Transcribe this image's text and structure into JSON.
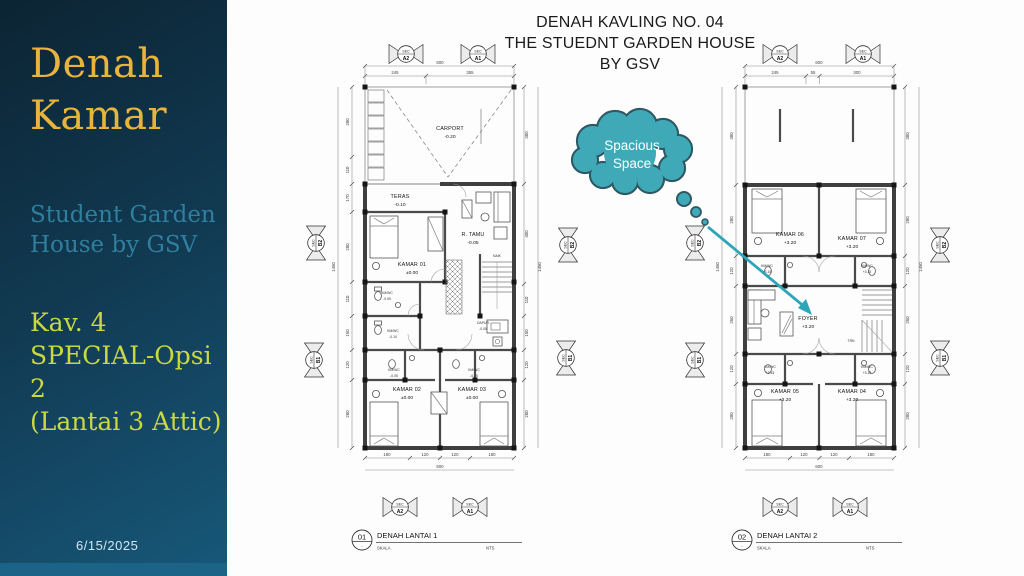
{
  "sidebar": {
    "title1": "Denah",
    "title2": "Kamar",
    "sub1": "Student Garden",
    "sub2": "House by GSV",
    "opt1": "Kav. 4",
    "opt2": "SPECIAL-Opsi 2",
    "opt3": "(Lantai 3 Attic)",
    "date": "6/15/2025"
  },
  "header": {
    "l1": "DENAH KAVLING NO. 04",
    "l2": "THE STUEDNT GARDEN HOUSE",
    "l3": "BY GSV"
  },
  "callout": {
    "l1": "Spacious",
    "l2": "Space"
  },
  "colors": {
    "cloud_fill": "#3FA9B8",
    "cloud_stroke": "#2E5863",
    "arrow": "#2CA6B8",
    "title_gold": "#E8B43C",
    "subtitle_teal": "#2F7F9E",
    "option_lime": "#C9D93F",
    "sidebar_top": "#0C2433",
    "sidebar_bottom": "#17587A",
    "footer_bar": "#1B6487"
  },
  "markers": {
    "sec": "SEC",
    "a1": "A1",
    "a2": "A2",
    "b1": "B1",
    "b2": "B2"
  },
  "plan1": {
    "num": "01",
    "title": "DENAH LANTAI 1",
    "skala": "SKALA",
    "scale_val": "NTS",
    "dim_top_total": "600",
    "dim_top": [
      "245",
      "355"
    ],
    "dim_bottom": [
      "180",
      "120",
      "120",
      "180"
    ],
    "dim_bottom_total": "600",
    "dim_left": [
      "280",
      "110",
      "170",
      "280",
      "110",
      "150",
      "120",
      "280"
    ],
    "dim_left_total": "1450",
    "dim_right": [
      "380",
      "400",
      "110",
      "150",
      "120",
      "280"
    ],
    "dim_right_total": "1450",
    "rooms": {
      "carport_n": "CARPORT",
      "carport_l": "-0.20",
      "teras_n": "TERAS",
      "teras_l": "-0.10",
      "kamar01_n": "KAMAR 01",
      "kamar01_l": "±0.00",
      "rtamu_n": "R. TAMU",
      "rtamu_l": "-0.05",
      "naik": "NAIK",
      "kmwc_a_n": "KM/WC",
      "kmwc_a_l": "-0.05",
      "kmwc_b_n": "KM/WC",
      "kmwc_b_l": "-0.10",
      "dapur_n": "DAPUR",
      "dapur_l": "-0.05",
      "kmwc_c_n": "KM/WC",
      "kmwc_c_l": "-0.05",
      "kmwc_d_n": "KM/WC",
      "kmwc_d_l": "-0.05",
      "kamar02_n": "KAMAR 02",
      "kamar02_l": "±0.00",
      "kamar03_n": "KAMAR 03",
      "kamar03_l": "±0.00"
    }
  },
  "plan2": {
    "num": "02",
    "title": "DENAH LANTAI 2",
    "skala": "SKALA",
    "scale_val": "NTS",
    "dim_top_total": "600",
    "dim_top": [
      "245",
      "55",
      "300"
    ],
    "dim_bottom": [
      "180",
      "120",
      "120",
      "180"
    ],
    "dim_bottom_total": "600",
    "dim_left": [
      "380",
      "280",
      "120",
      "260",
      "120",
      "280"
    ],
    "dim_left_total": "1450",
    "dim_right": [
      "380",
      "280",
      "120",
      "260",
      "120",
      "280"
    ],
    "dim_right_total": "1450",
    "rooms": {
      "kamar06_n": "KAMAR 06",
      "kamar06_l": "+3.20",
      "kamar07_n": "KAMAR 07",
      "kamar07_l": "+3.20",
      "kmwc_a_n": "KM/WC",
      "kmwc_a_l": "+3.15",
      "kmwc_b_n": "KM/WC",
      "kmwc_b_l": "+3.15",
      "foyer_n": "FOYER",
      "foyer_l": "+3.20",
      "trn": "TRN",
      "kmwc_c_n": "KM/WC",
      "kmwc_c_l": "+3.15",
      "kmwc_d_n": "KM/WC",
      "kmwc_d_l": "+3.15",
      "kamar05_n": "KAMAR 05",
      "kamar05_l": "+3.20",
      "kamar04_n": "KAMAR 04",
      "kamar04_l": "+3.20"
    }
  }
}
